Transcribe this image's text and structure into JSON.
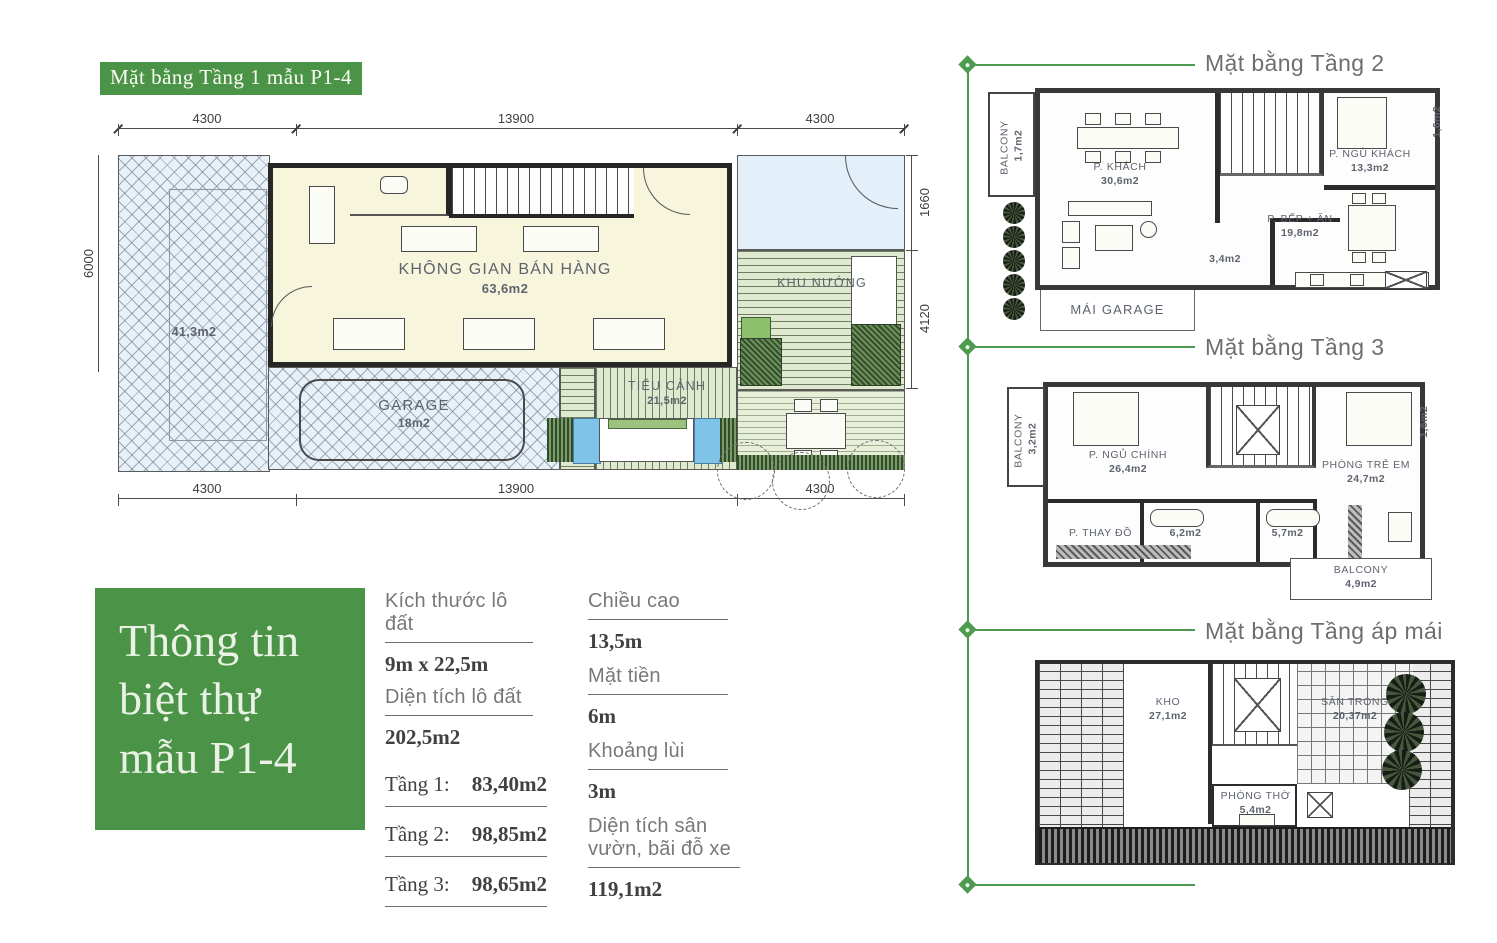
{
  "colors": {
    "green": "#4a9347",
    "label_gray": "#6d6e71"
  },
  "main_plan": {
    "title": "Mặt bằng Tầng 1 mẫu P1-4",
    "dims": {
      "top": [
        "4300",
        "13900",
        "4300"
      ],
      "bottom": [
        "4300",
        "13900",
        "4300"
      ],
      "left": [
        "6000"
      ],
      "right": [
        "1660",
        "4120"
      ]
    },
    "rooms": {
      "sales": {
        "name": "KHÔNG GIAN BÁN HÀNG",
        "area": "63,6m2"
      },
      "bbq": {
        "name": "KHU NƯỚNG",
        "area": ""
      },
      "garden": {
        "name": "TIỂU CẢNH",
        "area": "21,5m2"
      },
      "garage": {
        "name": "GARAGE",
        "area": "18m2"
      },
      "yard": {
        "name": "",
        "area": "41,3m2"
      }
    }
  },
  "floor2": {
    "title": "Mặt bằng Tầng 2",
    "rooms": {
      "balcony": {
        "name": "BALCONY",
        "area": "1,7m2"
      },
      "living": {
        "name": "P. KHÁCH",
        "area": "30,6m2"
      },
      "guest_bed": {
        "name": "P. NGỦ KHÁCH",
        "area": "13,3m2"
      },
      "small": {
        "area": "1,6m2"
      },
      "kitchen": {
        "name": "P. BẾP + ĂN",
        "area": "19,8m2"
      },
      "wc": {
        "area": "3,4m2"
      },
      "garage_roof": {
        "name": "MÁI GARAGE"
      }
    }
  },
  "floor3": {
    "title": "Mặt bằng Tầng 3",
    "rooms": {
      "balcony": {
        "name": "BALCONY",
        "area": "3,2m2"
      },
      "master": {
        "name": "P. NGỦ CHÍNH",
        "area": "26,4m2"
      },
      "kids": {
        "name": "PHÒNG TRẺ EM",
        "area": "24,7m2"
      },
      "small": {
        "area": "1,6m2"
      },
      "dressing": {
        "name": "P. THAY ĐỒ"
      },
      "bath1": {
        "area": "6,2m2"
      },
      "bath2": {
        "area": "5,7m2"
      },
      "balcony2": {
        "name": "BALCONY",
        "area": "4,9m2"
      }
    }
  },
  "attic": {
    "title": "Mặt bằng Tầng áp mái",
    "rooms": {
      "storage": {
        "name": "KHO",
        "area": "27,1m2"
      },
      "courtyard": {
        "name": "SÂN TRONG",
        "area": "20,37m2"
      },
      "worship": {
        "name": "PHÒNG THỜ",
        "area": "5,4m2"
      }
    }
  },
  "info_box": {
    "line1": "Thông tin",
    "line2": "biệt thự",
    "line3": "mẫu P1-4"
  },
  "specs": {
    "col1": [
      {
        "label": "Kích thước lô đất",
        "value": "9m x 22,5m"
      },
      {
        "label": "Diện tích lô đất",
        "value": "202,5m2"
      },
      {
        "label": "Tầng 1:",
        "value": "83,40m2"
      },
      {
        "label": "Tầng 2:",
        "value": "98,85m2"
      },
      {
        "label": "Tầng 3:",
        "value": "98,65m2"
      }
    ],
    "col2": [
      {
        "label": "Chiều cao",
        "value": "13,5m"
      },
      {
        "label": "Mặt tiền",
        "value": "6m"
      },
      {
        "label": "Khoảng lùi",
        "value": "3m"
      },
      {
        "label": "Diện tích sân vườn, bãi đỗ xe",
        "value": "119,1m2"
      },
      {
        "label2_line1": "Diện tích sân vườn,",
        "label2_line2": "bãi đỗ xe"
      }
    ]
  }
}
